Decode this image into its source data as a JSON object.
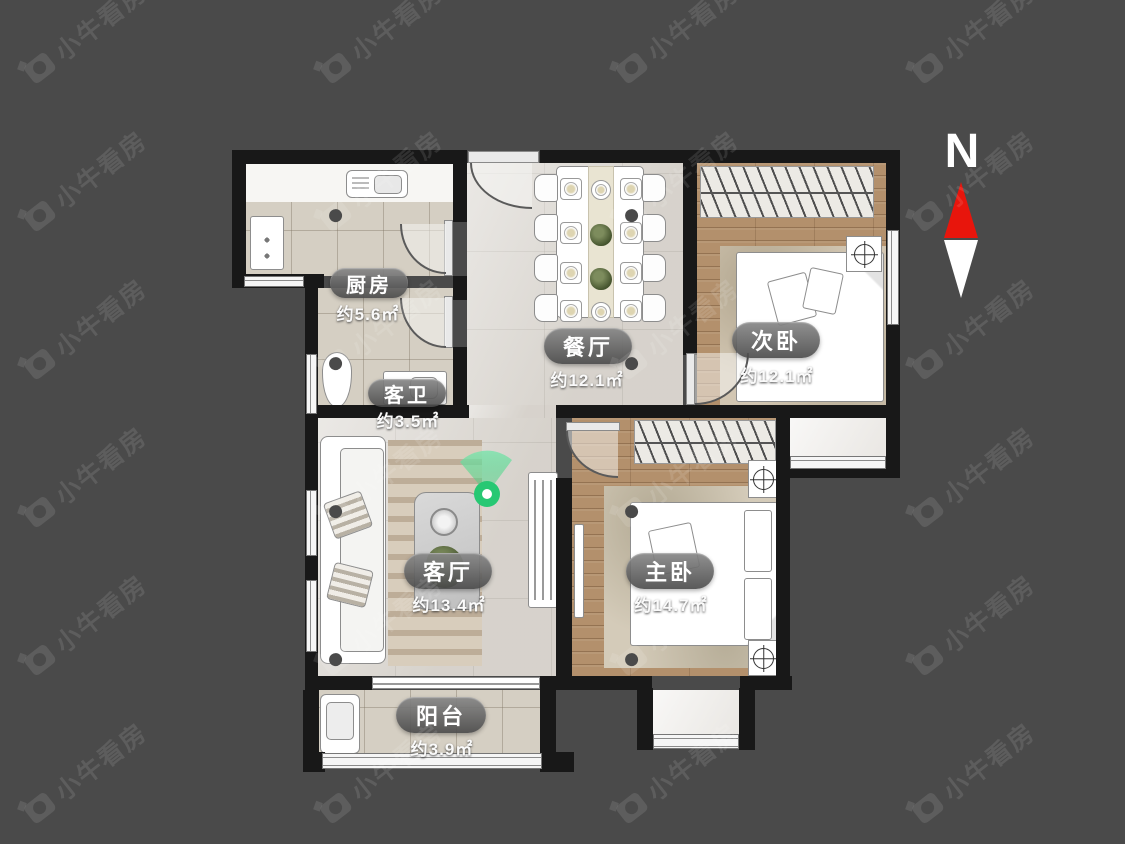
{
  "watermark": {
    "text": "小牛看房"
  },
  "compass": {
    "label": "N",
    "north_color": "#e8150c",
    "south_color": "#ffffff"
  },
  "colors": {
    "background": "#4a4a4a",
    "wall": "#181818",
    "vr_marker_green": "#2ecc71"
  },
  "rooms": {
    "kitchen": {
      "name": "厨房",
      "area": "约5.6㎡"
    },
    "guest_bath": {
      "name": "客卫",
      "area": "约3.5㎡"
    },
    "dining": {
      "name": "餐厅",
      "area": "约12.1㎡"
    },
    "second_bedroom": {
      "name": "次卧",
      "area": "约12.1㎡"
    },
    "living": {
      "name": "客厅",
      "area": "约13.4㎡"
    },
    "master_bedroom": {
      "name": "主卧",
      "area": "约14.7㎡"
    },
    "balcony": {
      "name": "阳台",
      "area": "约3.9㎡"
    }
  }
}
